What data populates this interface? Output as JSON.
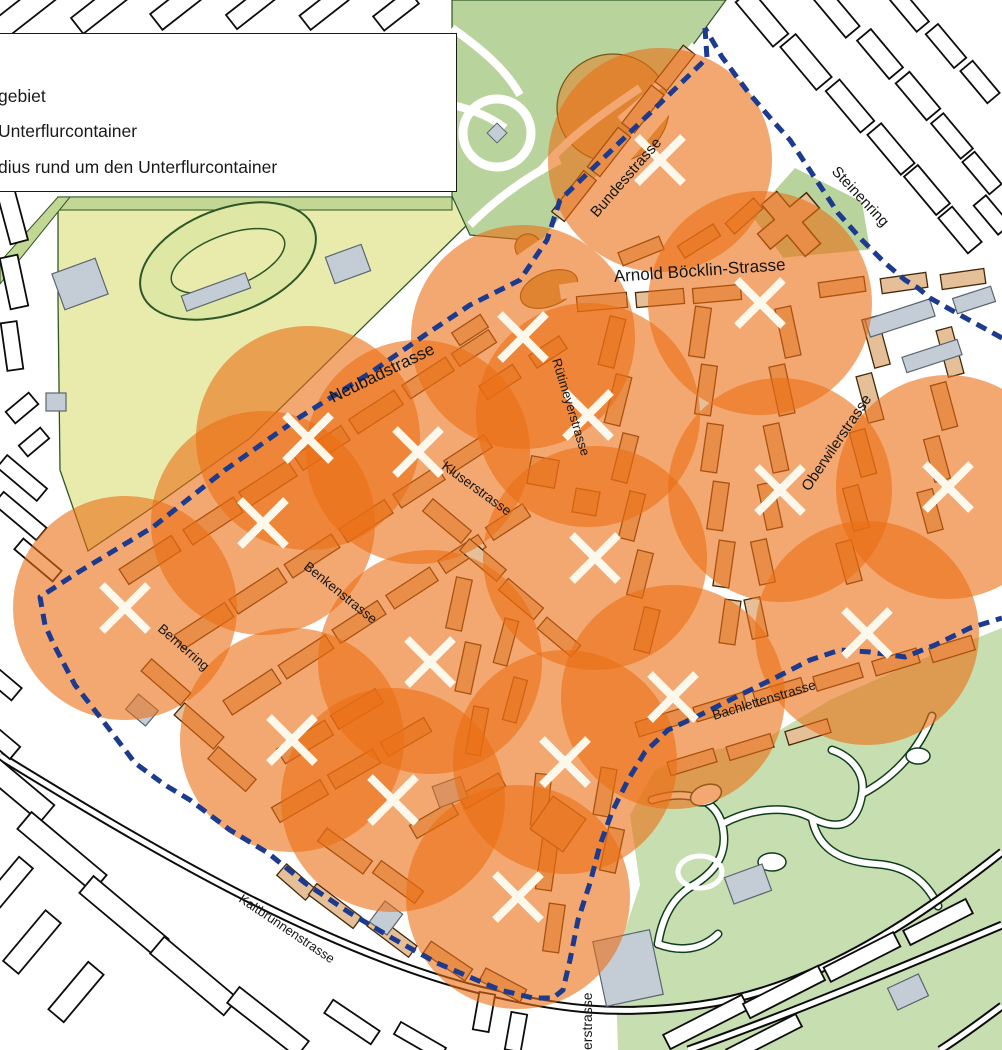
{
  "legend": {
    "items": [
      {
        "label": "gebiet"
      },
      {
        "label": "Unterflurcontainer"
      },
      {
        "label": "dius rund um den Unterflurcontainer"
      }
    ]
  },
  "map": {
    "width": 1002,
    "height": 1050,
    "colors": {
      "bg": "#ffffff",
      "circle_fill": "#eb6e14",
      "circle_opacity": 0.6,
      "boundary": "#1c3a8e",
      "cross": "#fdf8ec",
      "bldg_outer_fill": "#ffffff",
      "bldg_outer_stroke": "#0d0d0d",
      "bldg_inner_fill": "#e5bf97",
      "bldg_inner_stroke": "#46280a",
      "gray_fill": "#c4cdd6",
      "gray_stroke": "#5a6670",
      "field": "#e8ebac",
      "field_stroke": "#2e5626",
      "band": "#c2d794",
      "track_fill": "#dfe7a4",
      "park": "#b8d49c",
      "zoo": "#c7deb0",
      "zoo_stroke": "#113d1c",
      "tan": "#cfa65c",
      "tan_stroke": "#7a5313",
      "rail": "#0c0c0c",
      "label": "#161616"
    },
    "radius_px": 112,
    "containers": [
      [
        660,
        160
      ],
      [
        523,
        337
      ],
      [
        760,
        303
      ],
      [
        308,
        438
      ],
      [
        418,
        452
      ],
      [
        588,
        415
      ],
      [
        948,
        487
      ],
      [
        780,
        490
      ],
      [
        263,
        523
      ],
      [
        125,
        608
      ],
      [
        595,
        558
      ],
      [
        430,
        662
      ],
      [
        867,
        633
      ],
      [
        673,
        697
      ],
      [
        292,
        740
      ],
      [
        393,
        800
      ],
      [
        565,
        762
      ],
      [
        518,
        897
      ]
    ],
    "boundary_parts": [
      "705,28 707,58 560,200 547,240 520,280 470,305 425,335 370,373 300,417 225,470 153,527 77,573 40,597 45,625 53,643 75,685 100,717 135,763 165,785 190,800 230,830 268,853 305,883 350,913 392,938 437,963 458,972 500,990 533,998 553,998 563,990 570,960 578,920 590,883 600,845 612,812 628,780 645,752 668,730 700,715 740,695 775,678 810,660 840,650 870,652 905,657 935,645 970,628 1002,618",
      "1002,338 960,315 930,298 918,288 905,280 885,263 862,240 838,213 815,178 790,140 772,120 748,92 722,57 705,28"
    ],
    "streets": [
      {
        "name": "Bundesstrasse",
        "x": 597,
        "y": 218,
        "rot": -49,
        "size": 15,
        "anchor": "start"
      },
      {
        "name": "Steinenring",
        "x": 831,
        "y": 172,
        "rot": 47,
        "size": 15,
        "anchor": "start"
      },
      {
        "name": "Arnold Böcklin-Strasse",
        "x": 700,
        "y": 276,
        "rot": -4,
        "size": 17,
        "anchor": "middle"
      },
      {
        "name": "Neubadstrasse",
        "x": 333,
        "y": 403,
        "rot": -26,
        "size": 17,
        "anchor": "start"
      },
      {
        "name": "Rütimeyerstrasse",
        "x": 552,
        "y": 360,
        "rot": 73,
        "size": 13,
        "anchor": "start"
      },
      {
        "name": "Oberwilerstrasse",
        "x": 809,
        "y": 492,
        "rot": -56,
        "size": 15,
        "anchor": "start"
      },
      {
        "name": "Kluserstrasse",
        "x": 441,
        "y": 468,
        "rot": 36,
        "size": 13.5,
        "anchor": "start"
      },
      {
        "name": "Benkenstrasse",
        "x": 303,
        "y": 568,
        "rot": 39,
        "size": 13.5,
        "anchor": "start"
      },
      {
        "name": "Bernerring",
        "x": 157,
        "y": 630,
        "rot": 41,
        "size": 13.5,
        "anchor": "start"
      },
      {
        "name": "Bachlettenstrasse",
        "x": 714,
        "y": 720,
        "rot": -17,
        "size": 13.5,
        "anchor": "start"
      },
      {
        "name": "Kaltbrunnenstrasse",
        "x": 238,
        "y": 901,
        "rot": 34,
        "size": 13,
        "anchor": "start"
      },
      {
        "name": "erstrasse",
        "x": 592,
        "y": 1050,
        "rot": -90,
        "size": 14,
        "anchor": "start"
      }
    ],
    "polygons": {
      "field": "58,197 452,197 470,222 250,438 150,509 88,551 60,470 58,300",
      "park": "452,0 726,0 548,242 470,235 452,196",
      "zoo": "618,1050 615,960 640,885 630,815 655,770 700,752 760,742 830,700 920,660 1002,628 1002,1050",
      "church_green": "795,168 862,202 870,250 788,264 752,216",
      "band_top": "58,197 452,197 452,210 58,210",
      "band_diag": "0,262 58,197 70,197 0,284"
    },
    "features": {
      "track": {
        "cx": 228,
        "cy": 261,
        "rx": 92,
        "ry": 52,
        "rot": -21,
        "irx": 60,
        "iry": 26
      },
      "stadium": {
        "cx": 613,
        "cy": 108,
        "rx": 56,
        "ry": 54
      },
      "plaza_oval": {
        "cx": 549,
        "cy": 289,
        "rx": 30,
        "ry": 17,
        "rot": -22
      },
      "plaza_dot": {
        "cx": 528,
        "cy": 247,
        "r": 13
      },
      "park_ring": {
        "cx": 497,
        "cy": 133,
        "r": 34
      },
      "church": {
        "x": 791,
        "y": 224,
        "rot": -40
      }
    },
    "white_streets": [
      {
        "d": "M545,248 L712,52",
        "w": 16
      },
      {
        "d": "M80,570 L545,245",
        "w": 15
      },
      {
        "d": "M560,292 C700,272 850,258 1002,246",
        "w": 15
      },
      {
        "d": "M594,760 C596,850 600,950 602,1050",
        "w": 13
      }
    ],
    "park_paths": [
      "M452,28 C480,48 505,68 520,95",
      "M452,105 C475,110 492,118 505,128",
      "M540,172 C565,140 600,115 640,88",
      "M470,225 C505,190 540,170 560,160",
      "M620,120 C650,95 675,70 695,45"
    ],
    "zoo_paths": [
      "M652,800 C690,788 715,800 722,824 C730,856 712,874 692,886 C672,898 662,918 658,944",
      "M722,824 C756,806 790,806 812,818 C844,834 858,820 862,794 C866,772 850,756 832,750",
      "M812,818 C818,852 846,862 876,864 C910,866 928,884 938,906",
      "M862,794 C896,776 920,748 932,716",
      "M658,944 C680,952 702,950 718,934"
    ],
    "zoo_ponds": [
      {
        "cx": 706,
        "cy": 795,
        "rx": 16,
        "ry": 10,
        "rot": -20
      },
      {
        "cx": 772,
        "cy": 862,
        "rx": 14,
        "ry": 9,
        "rot": 0
      },
      {
        "cx": 918,
        "cy": 756,
        "rx": 12,
        "ry": 8,
        "rot": 0
      }
    ],
    "zoo_ring": {
      "cx": 700,
      "cy": 872,
      "rx": 22,
      "ry": 16
    },
    "railways": [
      "M0,756 C140,842 320,950 480,990 C560,1010 620,1016 700,1005 C810,990 910,925 1002,852",
      "M688,1050 C790,1014 900,968 1002,925",
      "M940,1050 C962,1036 986,1018 1002,1006"
    ],
    "buildings_inner": [
      [
        150,
        560,
        62,
        18,
        -33
      ],
      [
        213,
        521,
        60,
        18,
        -33
      ],
      [
        268,
        484,
        58,
        18,
        -33
      ],
      [
        322,
        448,
        56,
        17,
        -33
      ],
      [
        376,
        412,
        54,
        17,
        -33
      ],
      [
        428,
        378,
        52,
        16,
        -33
      ],
      [
        474,
        348,
        44,
        15,
        -33
      ],
      [
        204,
        626,
        60,
        17,
        -33
      ],
      [
        258,
        591,
        58,
        17,
        -33
      ],
      [
        312,
        556,
        56,
        16,
        -33
      ],
      [
        366,
        521,
        54,
        16,
        -33
      ],
      [
        419,
        487,
        52,
        16,
        -33
      ],
      [
        468,
        454,
        48,
        15,
        -33
      ],
      [
        252,
        692,
        58,
        17,
        -33
      ],
      [
        306,
        657,
        56,
        16,
        -33
      ],
      [
        359,
        622,
        54,
        16,
        -33
      ],
      [
        412,
        588,
        52,
        16,
        -33
      ],
      [
        462,
        554,
        48,
        15,
        -33
      ],
      [
        508,
        522,
        44,
        15,
        -33
      ],
      [
        166,
        682,
        52,
        16,
        41
      ],
      [
        199,
        726,
        52,
        16,
        41
      ],
      [
        232,
        769,
        50,
        16,
        41
      ],
      [
        305,
        742,
        56,
        17,
        -31
      ],
      [
        357,
        709,
        52,
        16,
        -31
      ],
      [
        300,
        801,
        56,
        17,
        -30
      ],
      [
        354,
        769,
        52,
        16,
        -30
      ],
      [
        406,
        737,
        50,
        16,
        -30
      ],
      [
        345,
        851,
        56,
        16,
        36
      ],
      [
        398,
        882,
        52,
        15,
        36
      ],
      [
        296,
        882,
        38,
        15,
        41
      ],
      [
        434,
        820,
        48,
        15,
        -30
      ],
      [
        482,
        791,
        46,
        15,
        -30
      ],
      [
        335,
        906,
        56,
        14,
        37
      ],
      [
        392,
        936,
        52,
        14,
        37
      ],
      [
        448,
        961,
        50,
        14,
        34
      ],
      [
        503,
        985,
        46,
        14,
        28
      ],
      [
        541,
        800,
        16,
        52,
        6
      ],
      [
        547,
        864,
        16,
        52,
        8
      ],
      [
        554,
        928,
        16,
        48,
        8
      ],
      [
        558,
        824,
        40,
        40,
        35
      ],
      [
        605,
        792,
        16,
        48,
        10
      ],
      [
        612,
        850,
        16,
        44,
        12
      ],
      [
        459,
        604,
        16,
        52,
        12
      ],
      [
        468,
        668,
        16,
        50,
        12
      ],
      [
        477,
        731,
        15,
        48,
        10
      ],
      [
        506,
        642,
        14,
        46,
        15
      ],
      [
        515,
        700,
        14,
        44,
        15
      ],
      [
        447,
        521,
        50,
        16,
        40
      ],
      [
        483,
        560,
        48,
        15,
        40
      ],
      [
        521,
        599,
        46,
        15,
        40
      ],
      [
        559,
        637,
        44,
        15,
        40
      ],
      [
        612,
        342,
        16,
        50,
        14
      ],
      [
        618,
        400,
        16,
        50,
        14
      ],
      [
        625,
        458,
        16,
        48,
        14
      ],
      [
        632,
        516,
        16,
        48,
        14
      ],
      [
        640,
        574,
        16,
        46,
        14
      ],
      [
        647,
        630,
        16,
        44,
        14
      ],
      [
        700,
        332,
        16,
        50,
        8
      ],
      [
        706,
        390,
        16,
        50,
        8
      ],
      [
        712,
        448,
        16,
        48,
        8
      ],
      [
        718,
        506,
        16,
        48,
        8
      ],
      [
        724,
        564,
        16,
        46,
        8
      ],
      [
        730,
        622,
        16,
        44,
        8
      ],
      [
        788,
        332,
        16,
        50,
        -12
      ],
      [
        782,
        390,
        16,
        50,
        -12
      ],
      [
        776,
        448,
        16,
        48,
        -12
      ],
      [
        770,
        506,
        16,
        46,
        -12
      ],
      [
        763,
        562,
        16,
        44,
        -12
      ],
      [
        756,
        618,
        16,
        40,
        -12
      ],
      [
        876,
        342,
        16,
        50,
        -15
      ],
      [
        870,
        398,
        16,
        48,
        -15
      ],
      [
        863,
        453,
        16,
        46,
        -15
      ],
      [
        856,
        508,
        16,
        44,
        -15
      ],
      [
        849,
        562,
        16,
        42,
        -15
      ],
      [
        950,
        352,
        16,
        48,
        -15
      ],
      [
        944,
        406,
        16,
        46,
        -15
      ],
      [
        937,
        459,
        16,
        44,
        -15
      ],
      [
        930,
        511,
        16,
        42,
        -15
      ],
      [
        602,
        302,
        50,
        15,
        -5
      ],
      [
        660,
        298,
        48,
        15,
        -5
      ],
      [
        717,
        294,
        48,
        15,
        -5
      ],
      [
        842,
        287,
        46,
        15,
        -8
      ],
      [
        904,
        283,
        46,
        15,
        -8
      ],
      [
        963,
        279,
        44,
        15,
        -8
      ],
      [
        574,
        196,
        52,
        16,
        -52
      ],
      [
        609,
        152,
        50,
        16,
        -52
      ],
      [
        643,
        109,
        48,
        16,
        -52
      ],
      [
        675,
        68,
        46,
        15,
        -52
      ],
      [
        641,
        251,
        44,
        14,
        -22
      ],
      [
        699,
        241,
        42,
        14,
        -32
      ],
      [
        744,
        216,
        38,
        14,
        -42
      ],
      [
        662,
        722,
        52,
        15,
        -17
      ],
      [
        720,
        707,
        52,
        15,
        -17
      ],
      [
        779,
        692,
        50,
        15,
        -17
      ],
      [
        838,
        677,
        48,
        15,
        -17
      ],
      [
        896,
        662,
        46,
        15,
        -17
      ],
      [
        952,
        649,
        44,
        15,
        -17
      ],
      [
        692,
        762,
        48,
        14,
        -17
      ],
      [
        750,
        747,
        46,
        14,
        -17
      ],
      [
        808,
        732,
        44,
        14,
        -17
      ],
      [
        543,
        472,
        28,
        28,
        10
      ],
      [
        586,
        502,
        24,
        24,
        10
      ],
      [
        500,
        382,
        40,
        16,
        -33
      ],
      [
        548,
        352,
        36,
        15,
        -33
      ],
      [
        470,
        330,
        34,
        15,
        -33
      ]
    ],
    "buildings_outer": [
      [
        22,
        12,
        68,
        22,
        -38
      ],
      [
        100,
        8,
        58,
        20,
        -38
      ],
      [
        178,
        5,
        55,
        20,
        -38
      ],
      [
        252,
        6,
        52,
        18,
        -38
      ],
      [
        324,
        8,
        48,
        18,
        -38
      ],
      [
        396,
        10,
        44,
        18,
        -38
      ],
      [
        12,
        215,
        18,
        56,
        -15
      ],
      [
        14,
        282,
        18,
        52,
        -12
      ],
      [
        12,
        346,
        16,
        48,
        -8
      ],
      [
        22,
        408,
        30,
        15,
        -40
      ],
      [
        34,
        442,
        28,
        14,
        -40
      ],
      [
        22,
        478,
        52,
        16,
        40
      ],
      [
        20,
        516,
        56,
        16,
        40
      ],
      [
        38,
        560,
        50,
        14,
        40
      ],
      [
        762,
        18,
        58,
        20,
        50
      ],
      [
        806,
        62,
        56,
        20,
        50
      ],
      [
        850,
        106,
        54,
        18,
        50
      ],
      [
        891,
        149,
        52,
        18,
        50
      ],
      [
        927,
        190,
        50,
        18,
        50
      ],
      [
        960,
        230,
        46,
        18,
        50
      ],
      [
        836,
        12,
        52,
        18,
        50
      ],
      [
        880,
        54,
        50,
        18,
        50
      ],
      [
        918,
        96,
        48,
        18,
        50
      ],
      [
        952,
        136,
        46,
        16,
        50
      ],
      [
        982,
        173,
        42,
        16,
        50
      ],
      [
        908,
        9,
        46,
        16,
        50
      ],
      [
        946,
        46,
        44,
        16,
        50
      ],
      [
        980,
        82,
        42,
        16,
        50
      ],
      [
        992,
        215,
        38,
        16,
        50
      ],
      [
        12,
        784,
        92,
        22,
        40
      ],
      [
        62,
        852,
        98,
        22,
        40
      ],
      [
        124,
        916,
        98,
        22,
        40
      ],
      [
        194,
        976,
        96,
        22,
        40
      ],
      [
        268,
        1022,
        88,
        20,
        38
      ],
      [
        32,
        942,
        20,
        66,
        40
      ],
      [
        76,
        992,
        20,
        62,
        40
      ],
      [
        8,
        884,
        18,
        56,
        40
      ],
      [
        2,
        682,
        38,
        16,
        40
      ],
      [
        2,
        742,
        34,
        16,
        40
      ],
      [
        352,
        1022,
        56,
        16,
        34
      ],
      [
        420,
        1041,
        52,
        14,
        30
      ],
      [
        484,
        1012,
        16,
        38,
        10
      ],
      [
        516,
        1032,
        16,
        38,
        10
      ],
      [
        706,
        1022,
        88,
        16,
        -27
      ],
      [
        784,
        992,
        84,
        16,
        -27
      ],
      [
        862,
        957,
        78,
        16,
        -27
      ],
      [
        938,
        922,
        70,
        16,
        -27
      ],
      [
        764,
        1038,
        78,
        14,
        -27
      ]
    ],
    "buildings_gray": [
      [
        900,
        318,
        68,
        18,
        -18
      ],
      [
        974,
        300,
        40,
        16,
        -18
      ],
      [
        932,
        356,
        58,
        16,
        -18
      ],
      [
        628,
        968,
        58,
        66,
        -12
      ],
      [
        748,
        884,
        40,
        28,
        -20
      ],
      [
        908,
        992,
        34,
        24,
        -25
      ],
      [
        142,
        710,
        26,
        20,
        40
      ],
      [
        386,
        918,
        22,
        26,
        37
      ],
      [
        450,
        792,
        30,
        22,
        -20
      ],
      [
        80,
        284,
        46,
        38,
        -20
      ],
      [
        216,
        292,
        68,
        16,
        -20
      ],
      [
        348,
        264,
        38,
        28,
        -20
      ],
      [
        56,
        402,
        20,
        18,
        0
      ]
    ]
  }
}
